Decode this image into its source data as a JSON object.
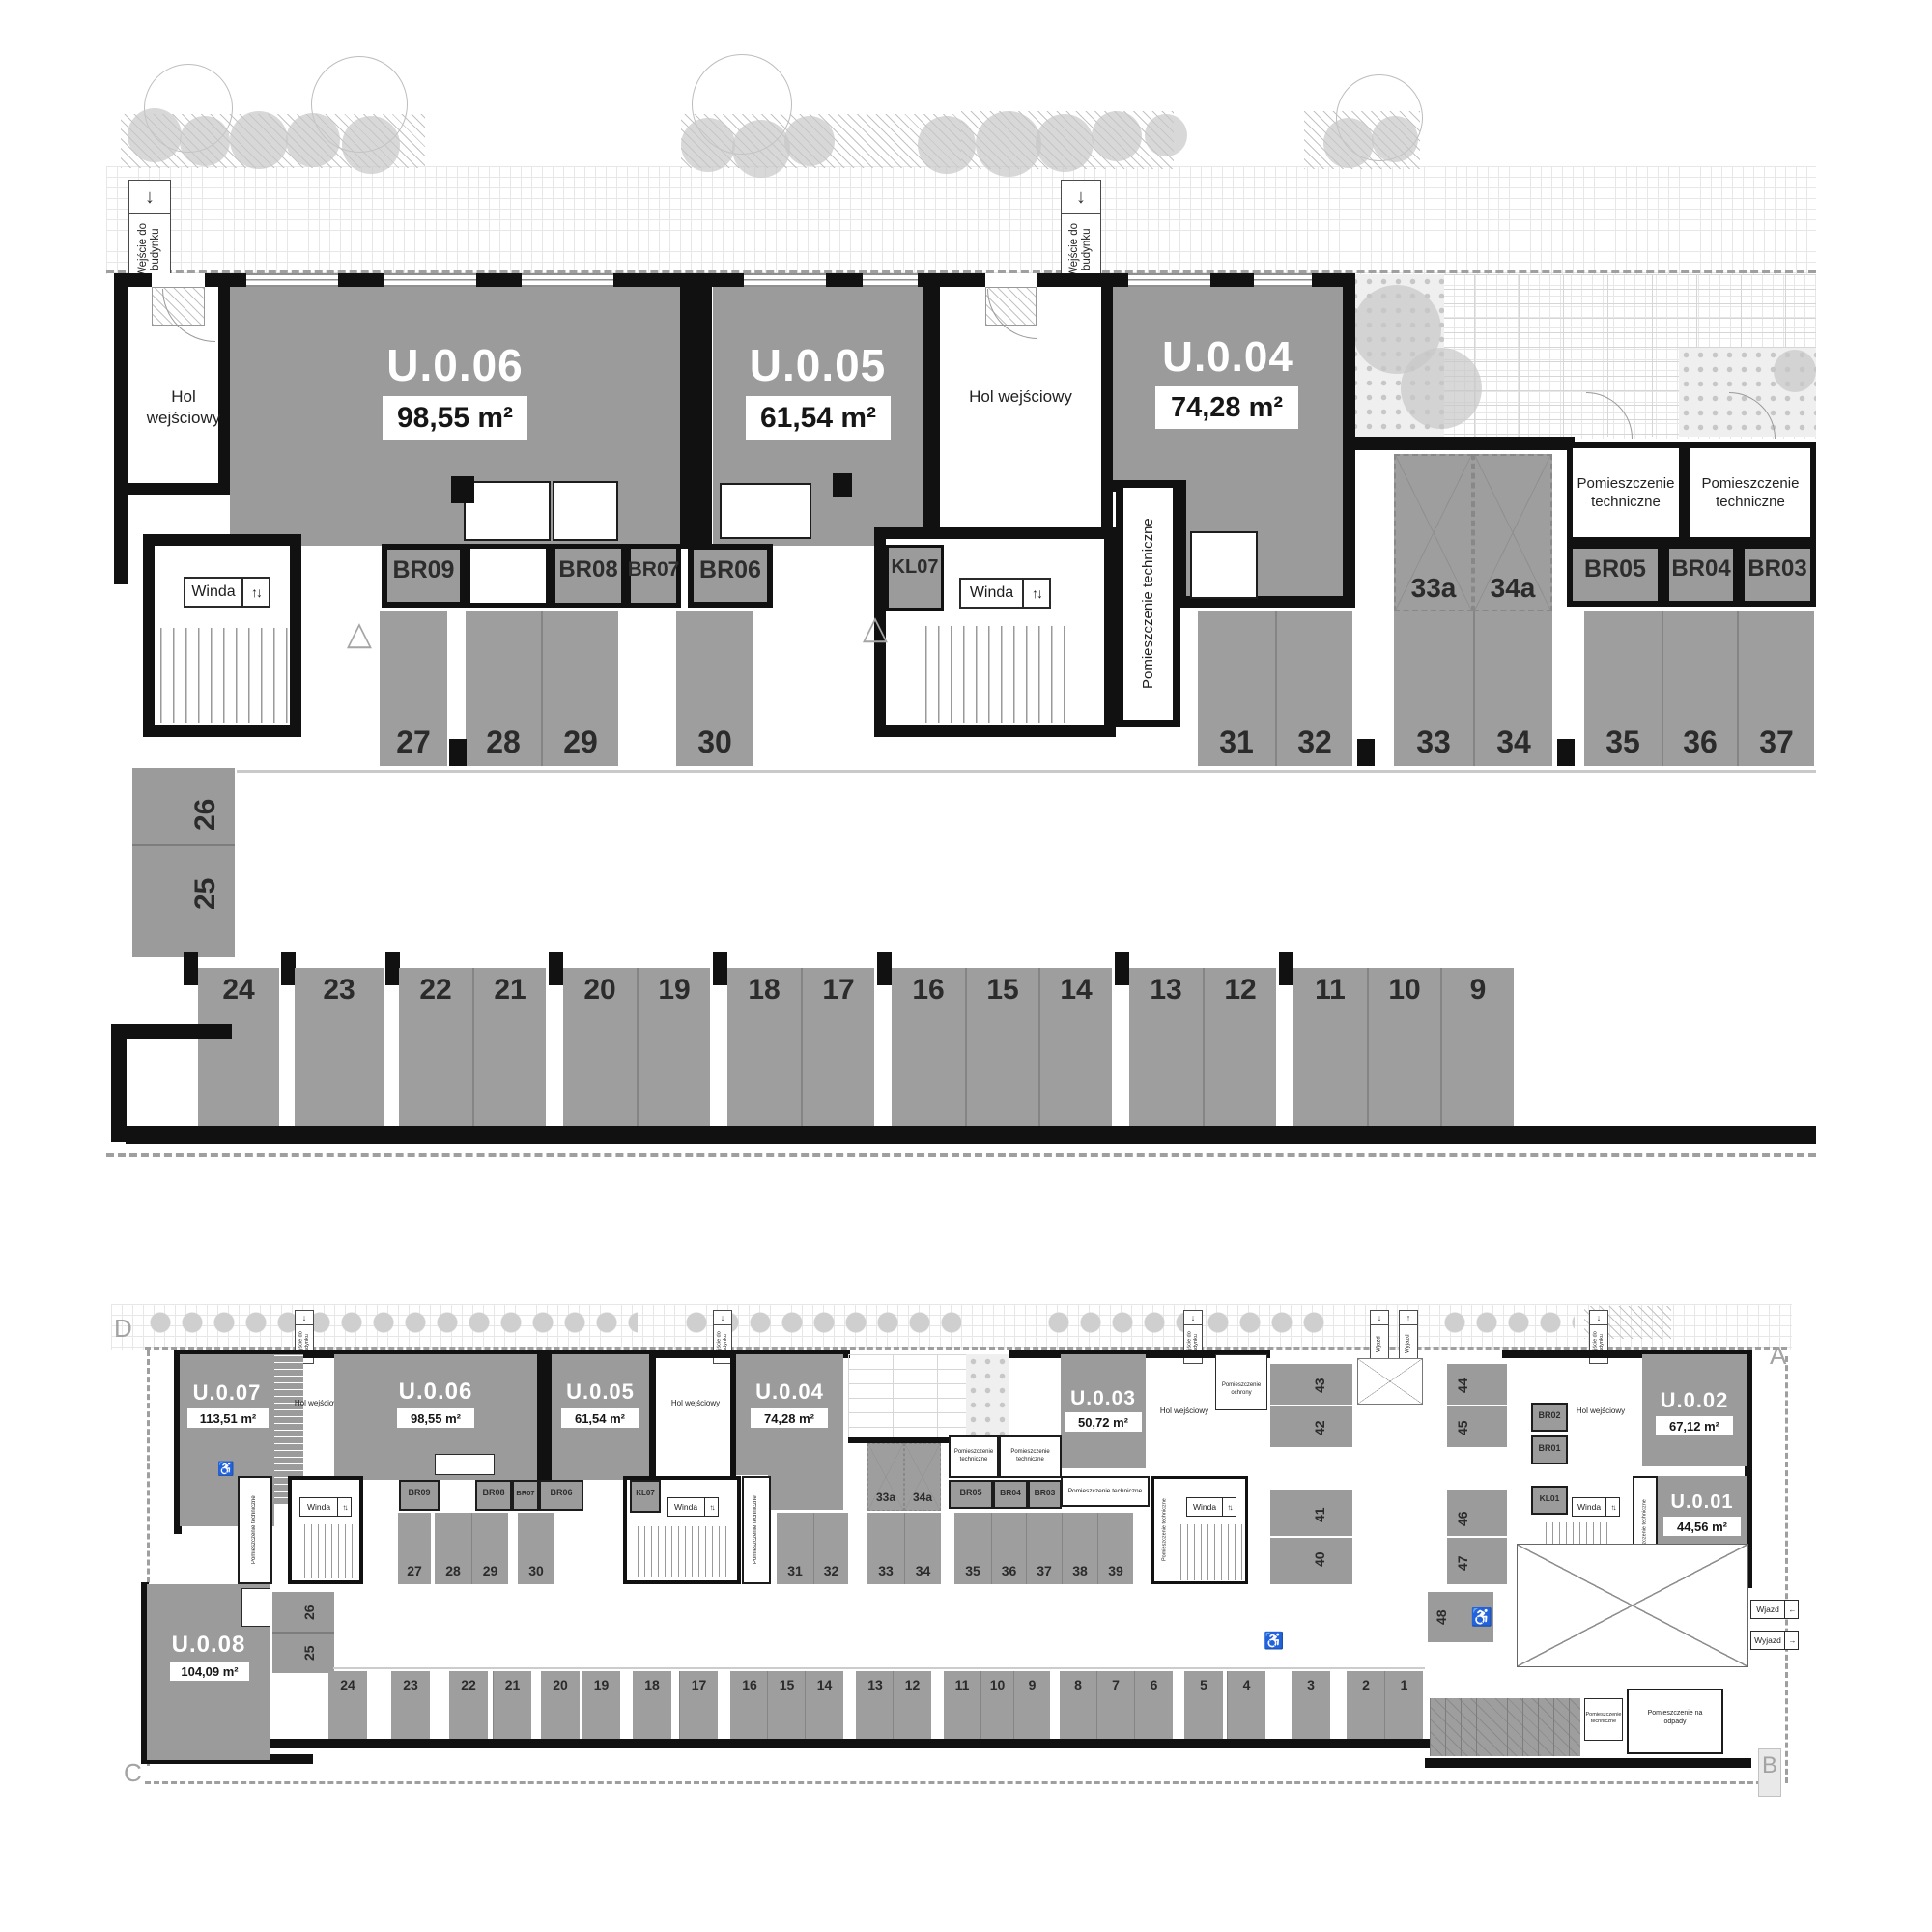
{
  "colors": {
    "unit_gray": "#9b9b9b",
    "parking_gray": "#9e9e9e",
    "highlight_orange": "#d99a55",
    "wall": "#111111"
  },
  "icons": {
    "down_arrow": "↓",
    "up_arrow": "↑",
    "up_down": "↑↓",
    "triangle": "△",
    "wheelchair": "♿",
    "arrow_left": "←",
    "arrow_right": "→"
  },
  "markers": {
    "a": "A",
    "b": "B",
    "c": "C",
    "d": "D"
  },
  "strings": {
    "entrance": "Wejście do budynku",
    "hol": "Hol wejściowy",
    "winda": "Winda",
    "pt": "Pomieszczenie techniczne",
    "ochrony": "Pomieszczenie ochrony",
    "odpady": "Pomieszczenie na odpady",
    "wjazd": "Wjazd",
    "wyjazd": "Wyjazd"
  },
  "top_plan": {
    "units": [
      {
        "id": "U.0.06",
        "area": "98,55 m²"
      },
      {
        "id": "U.0.05",
        "area": "61,54 m²"
      },
      {
        "id": "U.0.04",
        "area": "74,28 m²"
      }
    ],
    "rooms": [
      "BR09",
      "BR08",
      "BR07",
      "BR06",
      "KL07",
      "BR05",
      "BR04",
      "BR03"
    ],
    "row1": [
      "27",
      "28",
      "29",
      "30",
      "31",
      "32",
      "33",
      "34",
      "35",
      "36",
      "37"
    ],
    "stacked": [
      "33a",
      "34a"
    ],
    "side": [
      "26",
      "25"
    ],
    "row2": [
      "24",
      "23",
      "22",
      "21",
      "20",
      "19",
      "18",
      "17",
      "16",
      "15",
      "14",
      "13",
      "12",
      "11",
      "10",
      "9"
    ],
    "highlighted_space": "28"
  },
  "bottom_plan": {
    "units": [
      {
        "id": "U.0.07",
        "area": "113,51 m²"
      },
      {
        "id": "U.0.06",
        "area": "98,55 m²"
      },
      {
        "id": "U.0.05",
        "area": "61,54 m²"
      },
      {
        "id": "U.0.04",
        "area": "74,28 m²"
      },
      {
        "id": "U.0.03",
        "area": "50,72 m²"
      },
      {
        "id": "U.0.02",
        "area": "67,12 m²"
      },
      {
        "id": "U.0.01",
        "area": "44,56 m²"
      },
      {
        "id": "U.0.08",
        "area": "104,09 m²"
      }
    ],
    "rooms": [
      "BR09",
      "BR08",
      "BR07",
      "BR06",
      "KL07",
      "BR05",
      "BR04",
      "BR03",
      "BR02",
      "BR01",
      "KL01"
    ],
    "mid": [
      "27",
      "28",
      "29",
      "30",
      "31",
      "32",
      "33",
      "34",
      "35",
      "36",
      "37",
      "38",
      "39"
    ],
    "stacked": [
      "33a",
      "34a"
    ],
    "side": [
      "26",
      "25"
    ],
    "right": [
      "43",
      "42",
      "41",
      "40",
      "44",
      "45",
      "46",
      "47",
      "48"
    ],
    "bottom": [
      "24",
      "23",
      "22",
      "21",
      "20",
      "19",
      "18",
      "17",
      "16",
      "15",
      "14",
      "13",
      "12",
      "11",
      "10",
      "9",
      "8",
      "7",
      "6",
      "5",
      "4",
      "3",
      "2",
      "1"
    ],
    "highlighted_space": "28"
  }
}
